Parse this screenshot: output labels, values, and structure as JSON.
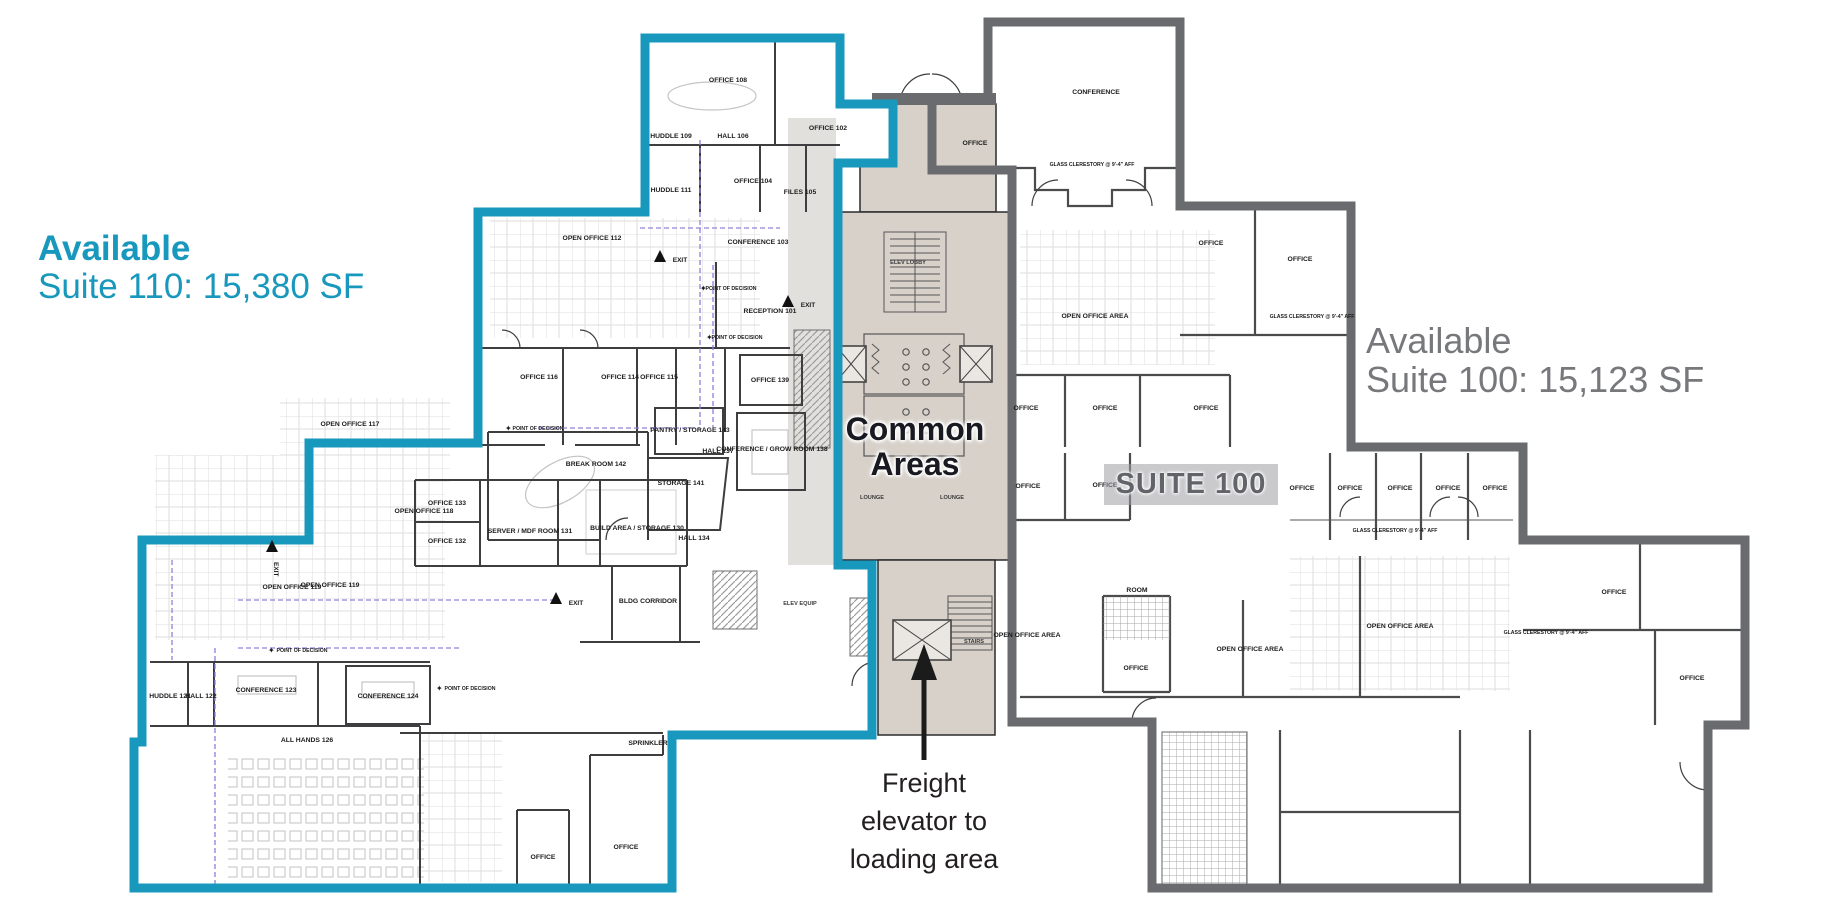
{
  "annotations": {
    "left_title": "Available",
    "left_subtitle": "Suite 110: 15,380 SF",
    "right_title": "Available",
    "right_subtitle": "Suite 100: 15,123 SF",
    "common_line1": "Common",
    "common_line2": "Areas",
    "suite100_badge": "SUITE 100",
    "freight_line1": "Freight",
    "freight_line2": "elevator to",
    "freight_line3": "loading area"
  },
  "colors": {
    "suite110_accent": "#1898BC",
    "suite100_accent": "#77787B",
    "suite100_border": "#6A6B6E",
    "common_area_fill": "#D8D1CA",
    "wall": "#3E3E40",
    "path_dash": "#8F80E0",
    "ink": "#231F20"
  },
  "suite110": {
    "rooms": [
      "OFFICE 108",
      "OFFICE 102",
      "HUDDLE 109",
      "HALL 106",
      "OFFICE 104",
      "FILES 105",
      "HUDDLE 111",
      "OPEN OFFICE 112",
      "CONFERENCE 103",
      "RECEPTION 101",
      "OFFICE 116",
      "OFFICE 114",
      "OFFICE 115",
      "OFFICE 139",
      "PANTRY / STORAGE 143",
      "BREAK ROOM 142",
      "STORAGE 141",
      "HALL 137",
      "CONFERENCE / GROW ROOM 138",
      "HALL 134",
      "OPEN OFFICE 117",
      "OPEN OFFICE 118",
      "OPEN OFFICE 119",
      "OPEN OFFICE 119",
      "OFFICE 133",
      "OFFICE 132",
      "SERVER / MDF ROOM 131",
      "BUILD AREA / STORAGE 130",
      "BLDG CORRIDOR",
      "HUDDLE 121",
      "HALL 122",
      "CONFERENCE 123",
      "CONFERENCE 124",
      "ALL HANDS 126",
      "OFFICE",
      "OFFICE",
      "SPRINKLER"
    ]
  },
  "common": {
    "rooms": [
      "ELEV LOBBY",
      "LOUNGE",
      "LOUNGE",
      "STAIRS",
      "ELEV EQUIP"
    ]
  },
  "suite100": {
    "rooms": [
      "CONFERENCE",
      "OFFICE",
      "OFFICE",
      "OFFICE",
      "OPEN OFFICE AREA",
      "OFFICE",
      "OFFICE",
      "OFFICE",
      "OFFICE",
      "OFFICE",
      "OFFICE",
      "OFFICE",
      "OFFICE",
      "OFFICE",
      "OFFICE",
      "OPEN OFFICE AREA",
      "OPEN OFFICE AREA",
      "OPEN OFFICE AREA",
      "OFFICE",
      "ROOM",
      "OFFICE",
      "OFFICE"
    ]
  },
  "markers": {
    "exit": "EXIT",
    "point_of_decision": "POINT OF DECISION",
    "glass_note": "GLASS CLERESTORY @ 9'-4\" AFF"
  }
}
